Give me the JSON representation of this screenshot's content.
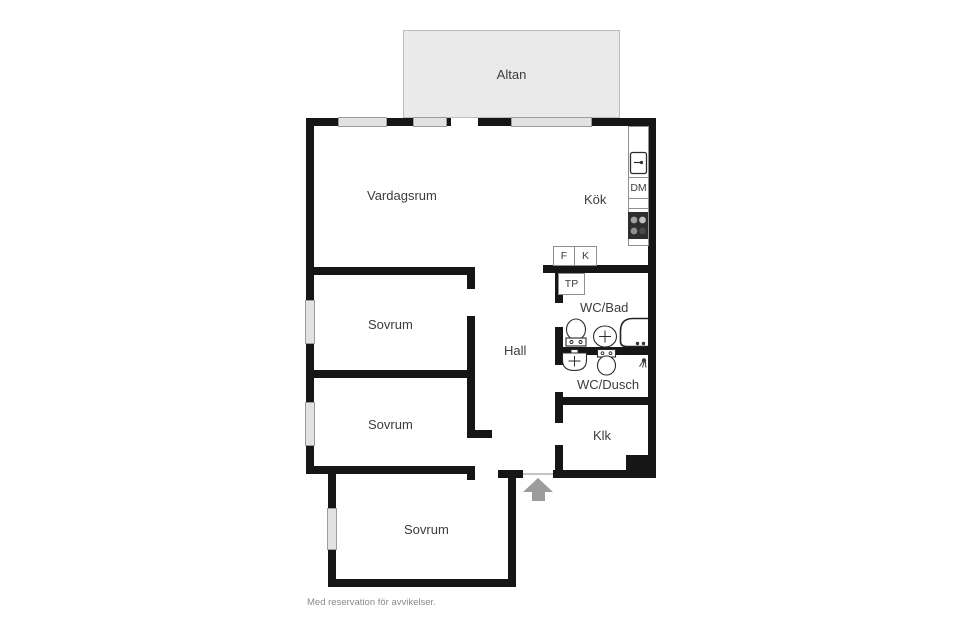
{
  "plan": {
    "labels": {
      "altan": "Altan",
      "vardagsrum": "Vardagsrum",
      "kok": "Kök",
      "sovrum1": "Sovrum",
      "sovrum2": "Sovrum",
      "sovrum3": "Sovrum",
      "hall": "Hall",
      "wc_bad": "WC/Bad",
      "wc_dusch": "WC/Dusch",
      "klk": "Klk"
    },
    "appliances": {
      "dm": "DM",
      "f": "F",
      "k": "K",
      "tp": "TP"
    },
    "icons": [
      "kitchen-sink-icon",
      "stove-icon",
      "toilet-icon",
      "washbasin-icon",
      "bathtub-icon",
      "shower-icon",
      "entrance-arrow-icon",
      "window"
    ],
    "colors": {
      "wall": "#161616",
      "window_fill": "#e2e2e2",
      "terrace_fill": "#eaeaea",
      "arrow": "#9c9c9c",
      "stove": "#2e2e2e",
      "label_text": "#3d3d3d",
      "disclaimer_text": "#8a8a8a"
    },
    "footer": {
      "disclaimer": "Med reservation för avvikelser."
    }
  }
}
